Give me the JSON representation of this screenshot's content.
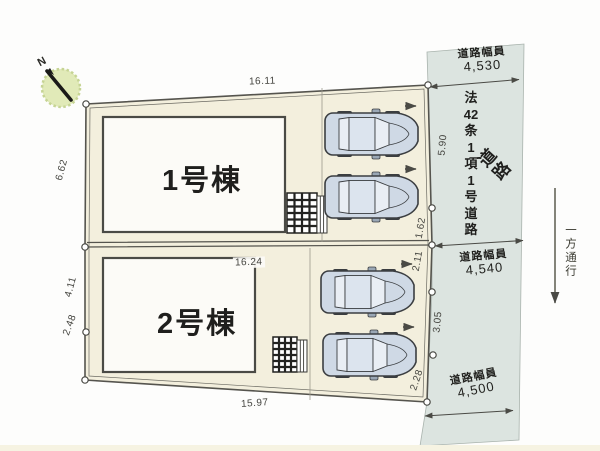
{
  "colors": {
    "lot_fill": "#f3efdd",
    "road_fill": "#dce4e0",
    "building_fill": "#fcfbf7",
    "line": "#4a4a45",
    "car_body": "#cfd9e5",
    "car_glass": "#e9eef4",
    "compass_fill": "#e1eab8"
  },
  "buildings": [
    {
      "name": "1号棟"
    },
    {
      "name": "2号棟"
    }
  ],
  "dimensions": {
    "top_width": "16.11",
    "lot2_width": "16.24",
    "bottom_width": "15.97",
    "left": [
      "6.62",
      "4.11",
      "2.48"
    ],
    "right": [
      "5.90",
      "1.62",
      "2.11",
      "3.05",
      "2.28"
    ]
  },
  "road": {
    "label_vertical": [
      "法",
      "42",
      "条",
      "1",
      "項",
      "1",
      "号",
      "道",
      "路"
    ],
    "label_diagonal": "道路",
    "widths": [
      {
        "caption": "道路幅員",
        "value": "4,530"
      },
      {
        "caption": "道路幅員",
        "value": "4,540"
      },
      {
        "caption": "道路幅員",
        "value": "4,500"
      }
    ],
    "one_way": "一方通行"
  },
  "compass": {
    "north": "N"
  }
}
